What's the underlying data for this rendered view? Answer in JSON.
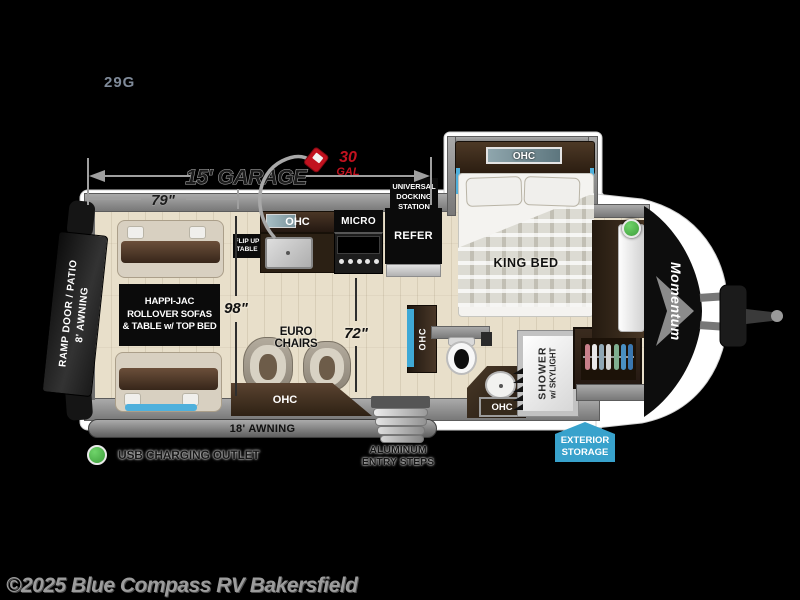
{
  "model": "29G",
  "dimensions": {
    "garage_length": "15' GARAGE",
    "garage_width": "79\"",
    "body_width": "98\"",
    "living_width": "72\"",
    "fuel_amount": "30",
    "fuel_unit": "GAL"
  },
  "exterior": {
    "docking_line1": "UNIVERSAL",
    "docking_line2": "DOCKING",
    "docking_line3": "STATION",
    "ramp_text_line1": "RAMP DOOR / PATIO",
    "ramp_text_line2": "8' AWNING",
    "main_awning": "18' AWNING",
    "steps_line1": "ALUMINUM",
    "steps_line2": "ENTRY STEPS",
    "storage_line1": "EXTERIOR",
    "storage_line2": "STORAGE",
    "brand_logo": "Momentum"
  },
  "interior": {
    "happijac_line1": "HAPPI-JAC",
    "happijac_line2": "ROLLOVER SOFAS",
    "happijac_line3": "& TABLE w/ TOP BED",
    "flip_table_line1": "FLIP UP",
    "flip_table_line2": "TABLE",
    "kitchen_ohc": "OHC",
    "micro": "MICRO",
    "refer": "REFER",
    "euro_chairs": "EURO CHAIRS",
    "chairs_ohc": "OHC",
    "tv_ohc": "OHC",
    "vanity_ohc": "OHC",
    "shower_line1": "SHOWER",
    "shower_line2": "w/ SKYLIGHT",
    "bed_ohc": "OHC",
    "king_bed": "KING BED"
  },
  "legend": {
    "usb": "USB CHARGING OUTLET"
  },
  "footer": {
    "copyright": "©2025 Blue Compass RV Bakersfield"
  },
  "colors": {
    "background": "#000000",
    "floor": "#e8dfca",
    "wall_gray": "#8f8f8f",
    "accent_blue": "#45a7d4",
    "storage_badge_blue": "#38a2cc",
    "fuel_red": "#c1121f",
    "usb_green": "#4cb848"
  }
}
